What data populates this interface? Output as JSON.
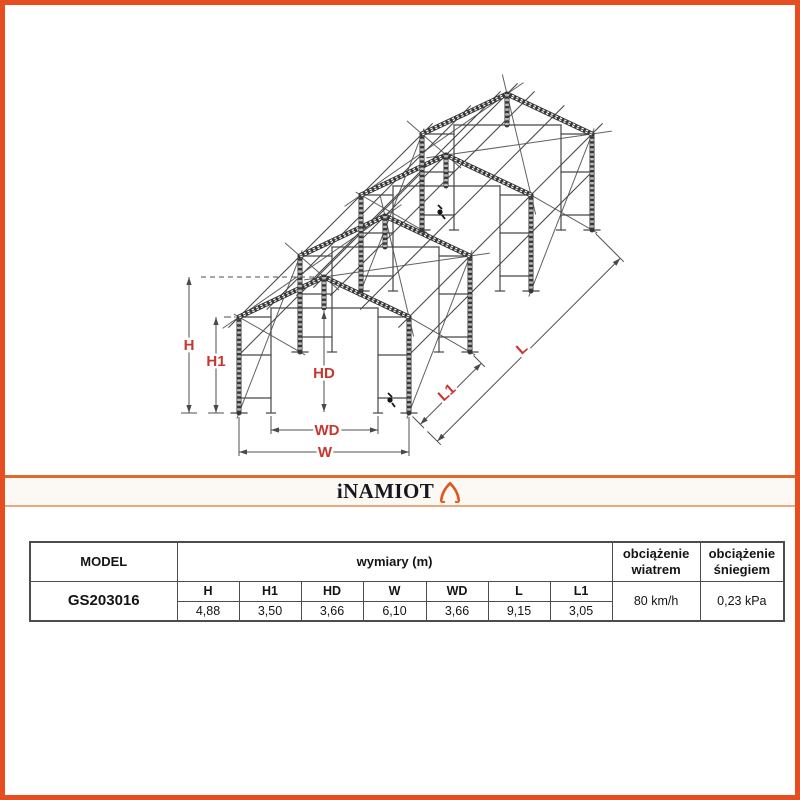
{
  "brand": {
    "logo_text": "iNAMIOT"
  },
  "diagram": {
    "labels": {
      "h": "H",
      "h1": "H1",
      "hd": "HD",
      "wd": "WD",
      "w": "W",
      "l": "L",
      "l1": "L1"
    }
  },
  "table": {
    "headers": {
      "model": "MODEL",
      "dimensions": "wymiary (m)",
      "wind": "obciążenie wiatrem",
      "snow": "obciążenie śniegiem"
    },
    "dim_columns": [
      "H",
      "H1",
      "HD",
      "W",
      "WD",
      "L",
      "L1"
    ],
    "row": {
      "model": "GS203016",
      "values": [
        "4,88",
        "3,50",
        "3,66",
        "6,10",
        "3,66",
        "9,15",
        "3,05"
      ],
      "wind": "80 km/h",
      "snow": "0,23 kPa"
    }
  },
  "colors": {
    "accent_orange": "#e64e22",
    "dim_label_red": "#c9362e"
  }
}
